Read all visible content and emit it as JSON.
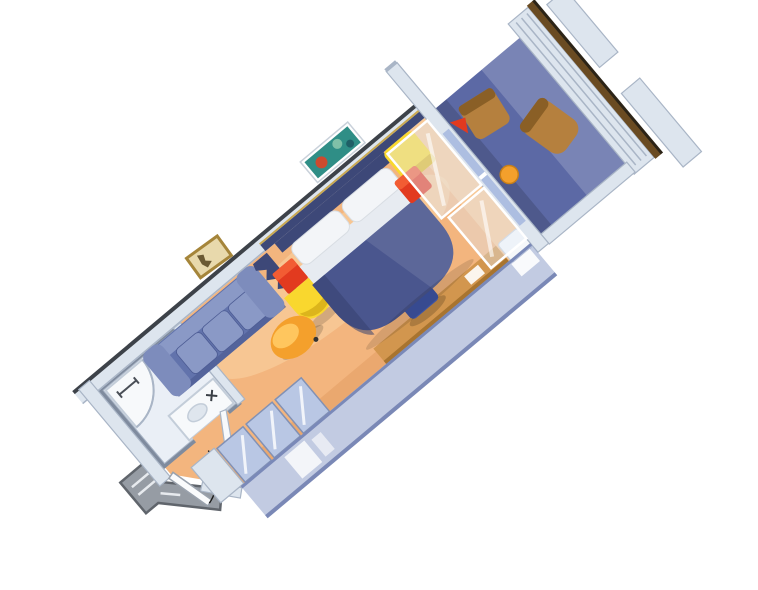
{
  "scene": {
    "title": "3D cutaway floor plan of a balcony stateroom",
    "view": "isometric, rotated diagonally, white background",
    "rooms": [
      {
        "name": "entry",
        "features": [
          "entry-door",
          "door-swing-arc",
          "hallway-threshold"
        ]
      },
      {
        "name": "bathroom",
        "features": [
          "shower",
          "toilet",
          "sink-counter",
          "bathroom-door"
        ]
      },
      {
        "name": "main-cabin",
        "features": [
          "sofa",
          "ottoman",
          "bed",
          "pillows",
          "headboard",
          "nightstand-red-cube-left",
          "nightstand-yellow-left",
          "nightstand-yellow-right",
          "nightstand-red-cube-right",
          "desk",
          "desk-chair",
          "white-bench",
          "wardrobe-mirror-doors",
          "artwork-seascape",
          "artwork-gold-frame",
          "cutaway-wall-stub",
          "translucent-near-wall",
          "glass-door-reflection"
        ]
      },
      {
        "name": "balcony",
        "features": [
          "sliding-glass-door",
          "deck-chair",
          "deck-lounger",
          "balcony-table",
          "red-accent",
          "back-wall-panels",
          "wood-railing-cap",
          "side-partitions"
        ]
      }
    ]
  },
  "colors": {
    "bg": "#ffffff",
    "floor": "#f3b57e",
    "floor_light": "#fcdcae",
    "floor_shadow": "#d98f54",
    "bath_floor": "#eaeff6",
    "fixture": "#f7f9fb",
    "fixture_line": "#c3cdd9",
    "wall_light": "#dde5ee",
    "wall_mid": "#a9b5c6",
    "wall_dark": "#7f8b9e",
    "wall_edge": "#3d4249",
    "navy_wall": "#3d4878",
    "gold_trim": "#c9a952",
    "bed": "#4a568e",
    "bed_dark": "#374270",
    "pillow": "#f3f5f8",
    "sheet": "#e7ebf1",
    "sofa": "#6273ac",
    "sofa_cushion": "#8a99c6",
    "sofa_arm": "#7d8cbc",
    "sofa_dark": "#4d5c94",
    "red": "#e23a1f",
    "red_light": "#f25c33",
    "yellow": "#f9d72e",
    "yellow_dark": "#dcb51c",
    "orange": "#f4a02c",
    "orange_light": "#ffc65e",
    "desk": "#d2964e",
    "desk_dark": "#a8742f",
    "chair": "#3f55a4",
    "chair_dark": "#2c3d7b",
    "wardrobe": "#b9c7e4",
    "wardrobe_frame": "#8291b4",
    "balcony_floor": "#5c69a5",
    "deck_brown": "#b5803e",
    "deck_dark": "#8a5f26",
    "railing": "#6a4b22",
    "railing_edge": "#2c2417",
    "glass": "#a5b7de",
    "glass_light": "#e2eaf6",
    "near_wall": "#8fa0cb",
    "near_wall_edge": "#6d7cae",
    "hallway": "#969ca4",
    "hallway_dark": "#60656c",
    "art_teal": "#2f8e86",
    "art_red": "#cc4a2e",
    "art_gold": "#c9a952",
    "art_beige": "#e8d9ac"
  }
}
